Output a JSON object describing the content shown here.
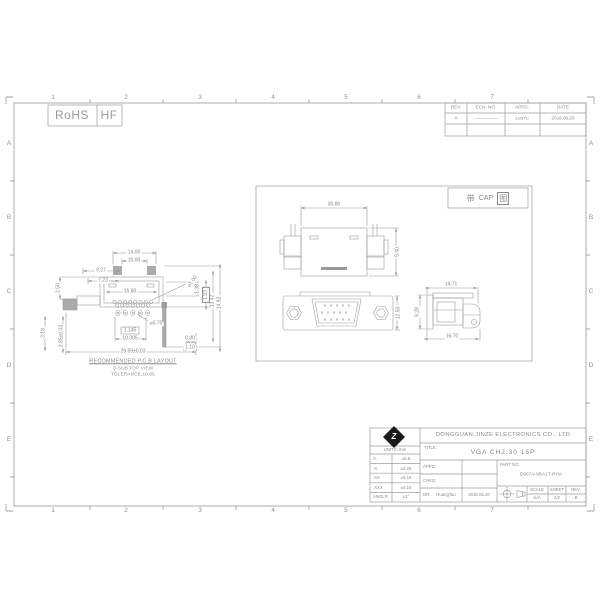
{
  "sheet": {
    "zone_cols": [
      "1",
      "2",
      "3",
      "4",
      "5",
      "6",
      "7"
    ],
    "zone_rows": [
      "A",
      "B",
      "C",
      "D",
      "E"
    ]
  },
  "rohs_badge": {
    "rohs": "RoHS",
    "hf": "HF"
  },
  "revision_table": {
    "headers": [
      "REV.",
      "ECN. NO.",
      "APPD.",
      "DATE"
    ],
    "row": {
      "rev": "A",
      "ecn_no": "—————",
      "appd": "LuoYu",
      "date": "2018.06.20"
    }
  },
  "main_view": {
    "captions": {
      "line1": "RECOMMENDED P.C.B LAYOUT",
      "line2": "D-SUB TOP VIEW",
      "line3": "TOLERANCE:±0.05"
    },
    "dims": {
      "tab_outer": "14.00",
      "tab_inner": "10.00",
      "offset_a": "9.27",
      "offset_b": "7.23",
      "shell_width": "16.80",
      "hole_dia": "⌀1.00",
      "pad_hole_dia": "⌀0.70",
      "pitch": "1.145",
      "row_span": "10.305",
      "tail_w1": "0.80",
      "tail_w2": "1.10",
      "overall": "29.99±0.03",
      "left_a": "2.50",
      "left_b": "3.18",
      "left_c": "2.85±0.03",
      "right_a": "1.38",
      "right_b": "1.93",
      "right_c": "13.42",
      "right_d": "14.92"
    }
  },
  "detail_view": {
    "label": {
      "prefix": "带",
      "mid": "CAP",
      "suffix": "图"
    },
    "dims": {
      "top_width": "30.80",
      "top_height": "9.40",
      "front_height": "12.50",
      "side_top": "14.71",
      "side_left": "9.28",
      "side_bottom": "16.70"
    }
  },
  "title_block": {
    "company": "DONGGUAN JINZE ELECTRONICS CO., LTD",
    "title_label": "TITLE:",
    "title": "VGA CH2.30 15P",
    "units_label": "UNITS: mm",
    "tolerances": [
      {
        "label": "X.",
        "value": "±0.5"
      },
      {
        "label": ".X",
        "value": "±0.25"
      },
      {
        "label": ".XX",
        "value": "±0.15"
      },
      {
        "label": ".XXX",
        "value": "±0.10"
      },
      {
        "label": "ANGLR",
        "value": "±2°"
      }
    ],
    "appd_label": "APPD:",
    "chkd_label": "CHKD:",
    "dr_label": "DR:",
    "dr_name": "HuangTao",
    "dr_date": "2018.06.20",
    "part_no_label": "PART NO:",
    "part_no": "D907A-9BA1T-RHA",
    "scale_label": "SCALE",
    "scale": "N/A",
    "sheet_label": "SHEET",
    "sheet": "2/2",
    "rev_label": "REV.",
    "rev": "B",
    "logo_letter": "Z"
  },
  "icons": {
    "logo": "jinze-diamond-logo",
    "projection": "third-angle-projection-symbol"
  },
  "colors": {
    "line": "#9b9b9b",
    "text": "#8a8a8a",
    "fill": "#ababab",
    "logo": "#1a1a1a"
  }
}
